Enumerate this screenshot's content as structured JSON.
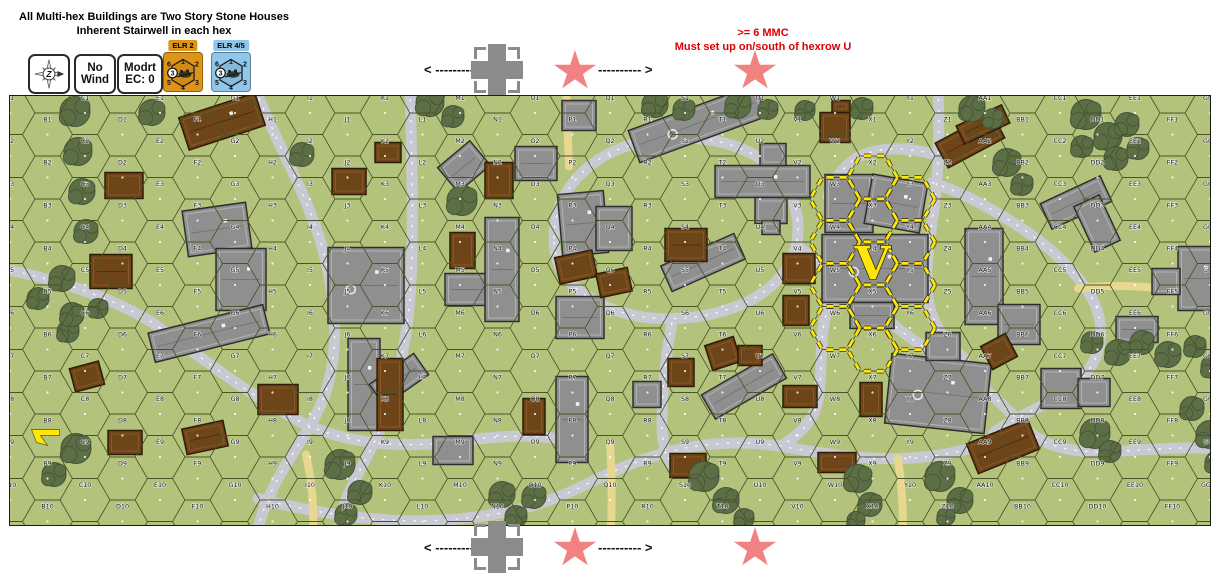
{
  "header": {
    "instructions_line1": "All Multi-hex Buildings are Two Story Stone Houses",
    "instructions_line2": "Inherent Stairwell in each hex",
    "counters": {
      "compass": {
        "letter": "Z"
      },
      "wind": {
        "line1": "No",
        "line2": "Wind"
      },
      "conditions": {
        "line1": "Modrt",
        "line2": "EC: 0"
      },
      "elr_axis": {
        "tab": "ELR 2",
        "color": "#dd9418",
        "edge_numbers": [
          "6",
          "1",
          "2",
          "5",
          "4",
          "3"
        ],
        "circled_value": "3"
      },
      "elr_allied": {
        "tab": "ELR 4/5",
        "color": "#8fc6e9",
        "edge_numbers": [
          "6",
          "1",
          "2",
          "5",
          "4",
          "3"
        ],
        "circled_value": "3"
      }
    },
    "setup_note": {
      "line1": ">= 6 MMC",
      "line2": "Must set up on/south of hexrow U",
      "color": "#dd0000"
    }
  },
  "strips": {
    "top": {
      "left": "< ----------",
      "right": "---------- >"
    },
    "bottom": {
      "left": "< ----------",
      "right": "---------- >"
    }
  },
  "map": {
    "columns": [
      "A",
      "B",
      "C",
      "D",
      "E",
      "F",
      "G",
      "H",
      "I",
      "J",
      "K",
      "L",
      "M",
      "N",
      "O",
      "P",
      "Q",
      "R",
      "S",
      "T",
      "U",
      "V",
      "W",
      "X",
      "Y",
      "Z",
      "AA",
      "BB",
      "CC",
      "DD",
      "EE",
      "FF",
      "GG"
    ],
    "rows": 10,
    "colors": {
      "grass": "#b3c37c",
      "hexline": "#4a5528",
      "road": "#c9c9d3",
      "road_center": "#ffffff",
      "dirt": "#e7d78f",
      "stone": "#8f8f8f",
      "stone_edge": "#2f2f2f",
      "stone_inner": "#c4c4c4",
      "wood": "#6e4419",
      "wood_edge": "#2e1c08",
      "wood_inner": "#96652f",
      "tree": "#5c6e44",
      "tree_edge": "#43523a",
      "setup_yellow": "#ffe60a",
      "setup_under": "#262615"
    },
    "v_marker": {
      "label": "V",
      "hex": "X4"
    },
    "setup_hexes": [
      "W3",
      "W4",
      "W5",
      "W6",
      "X2",
      "X3",
      "X4",
      "X5",
      "X6",
      "Y3",
      "Y4",
      "Y5",
      "Y6"
    ],
    "arrow_marker_hex": "B8",
    "roads": [
      "M 245,-8 C 268,50 298,100 312,150 C 326,200 330,250 316,295 C 300,342 262,375 248,432",
      "M 400,-8 C 402,70 404,140 400,200 C 396,258 380,318 356,362 C 338,396 330,415 330,432",
      "M -8,172 C 50,184 100,200 142,226 C 186,256 232,295 290,325 C 336,348 392,352 446,345 C 492,339 522,338 546,342",
      "M 248,402 C 310,418 380,428 442,423 C 502,418 540,406 576,388 C 612,370 642,358 678,351 C 712,345 742,345 772,350 C 830,360 860,363 892,362 C 928,361 958,354 984,344",
      "M 544,142 C 544,94 580,54 640,44 C 700,34 760,52 780,96 C 798,136 786,180 740,204 C 696,226 636,228 596,210 C 560,194 544,172 544,142 Z",
      "M 788,150 C 826,178 858,206 888,232 C 918,256 950,272 974,292 C 996,310 1008,324 1018,334 C 1034,350 1064,357 1102,355 C 1142,353 1176,350 1208,352",
      "M 928,-8 C 930,40 928,88 922,126 C 918,156 914,184 919,208 C 924,230 936,246 954,262",
      "M 922,86 C 952,96 982,112 1012,132 C 1042,152 1062,172 1076,192 C 1090,212 1094,232 1088,254 C 1082,278 1058,296 1030,310 C 1006,322 992,330 984,336",
      "M 662,226 C 656,258 652,292 652,326 C 652,346 656,358 662,368",
      "M 846,164 C 828,184 816,208 813,234 C 810,258 812,284 808,304 C 804,324 790,338 772,349",
      "M 924,58 C 896,50 866,50 846,62 C 831,72 822,86 818,100"
    ],
    "dirt_roads": [
      "M 556,-8 C 557,20 558,45 559,70",
      "M 600,348 C 602,375 602,404 601,432",
      "M 888,362 C 892,390 893,412 893,432",
      "M 1068,192 C 1110,186 1155,192 1208,198",
      "M 296,358 C 302,385 304,408 303,432"
    ],
    "buildings": [
      {
        "x": 175,
        "y": 110,
        "w": 64,
        "h": 46,
        "rot": -8,
        "type": "stone"
      },
      {
        "x": 206,
        "y": 152,
        "w": 50,
        "h": 62,
        "rot": 0,
        "type": "stone"
      },
      {
        "x": 318,
        "y": 151,
        "w": 76,
        "h": 76,
        "rot": 0,
        "type": "stone"
      },
      {
        "x": 140,
        "y": 222,
        "w": 118,
        "h": 30,
        "rot": -14,
        "type": "stone"
      },
      {
        "x": 505,
        "y": 50,
        "w": 42,
        "h": 34,
        "rot": 0,
        "type": "stone"
      },
      {
        "x": 433,
        "y": 54,
        "w": 42,
        "h": 32,
        "rot": -40,
        "type": "stone"
      },
      {
        "x": 552,
        "y": 4,
        "w": 34,
        "h": 30,
        "rot": 0,
        "type": "stone"
      },
      {
        "x": 620,
        "y": 10,
        "w": 135,
        "h": 34,
        "rot": -20,
        "type": "stone"
      },
      {
        "x": 550,
        "y": 96,
        "w": 46,
        "h": 62,
        "rot": -5,
        "type": "stone"
      },
      {
        "x": 586,
        "y": 110,
        "w": 36,
        "h": 44,
        "rot": 0,
        "type": "stone"
      },
      {
        "x": 705,
        "y": 69,
        "w": 95,
        "h": 32,
        "rot": 0,
        "type": "stone"
      },
      {
        "x": 750,
        "y": 47,
        "w": 26,
        "h": 22,
        "rot": 0,
        "type": "stone"
      },
      {
        "x": 745,
        "y": 101,
        "w": 32,
        "h": 26,
        "rot": 0,
        "type": "stone"
      },
      {
        "x": 752,
        "y": 124,
        "w": 18,
        "h": 14,
        "rot": 0,
        "type": "stone"
      },
      {
        "x": 653,
        "y": 152,
        "w": 80,
        "h": 28,
        "rot": -24,
        "type": "stone"
      },
      {
        "x": 546,
        "y": 200,
        "w": 48,
        "h": 42,
        "rot": 0,
        "type": "stone"
      },
      {
        "x": 435,
        "y": 177,
        "w": 52,
        "h": 32,
        "rot": 0,
        "type": "stone"
      },
      {
        "x": 475,
        "y": 121,
        "w": 34,
        "h": 104,
        "rot": 0,
        "type": "stone"
      },
      {
        "x": 338,
        "y": 242,
        "w": 32,
        "h": 92,
        "rot": 0,
        "type": "stone"
      },
      {
        "x": 362,
        "y": 270,
        "w": 54,
        "h": 26,
        "rot": -35,
        "type": "stone"
      },
      {
        "x": 546,
        "y": 280,
        "w": 32,
        "h": 86,
        "rot": 0,
        "type": "stone"
      },
      {
        "x": 623,
        "y": 285,
        "w": 28,
        "h": 26,
        "rot": 0,
        "type": "stone"
      },
      {
        "x": 693,
        "y": 276,
        "w": 82,
        "h": 28,
        "rot": -30,
        "type": "stone"
      },
      {
        "x": 423,
        "y": 340,
        "w": 40,
        "h": 28,
        "rot": 0,
        "type": "stone"
      },
      {
        "x": 815,
        "y": 78,
        "w": 48,
        "h": 58,
        "rot": 0,
        "type": "stone"
      },
      {
        "x": 858,
        "y": 82,
        "w": 56,
        "h": 50,
        "rot": 10,
        "type": "stone"
      },
      {
        "x": 812,
        "y": 138,
        "w": 106,
        "h": 68,
        "rot": 0,
        "type": "stone"
      },
      {
        "x": 840,
        "y": 206,
        "w": 44,
        "h": 26,
        "rot": 0,
        "type": "stone"
      },
      {
        "x": 955,
        "y": 132,
        "w": 38,
        "h": 96,
        "rot": 0,
        "type": "stone"
      },
      {
        "x": 988,
        "y": 208,
        "w": 42,
        "h": 40,
        "rot": 0,
        "type": "stone"
      },
      {
        "x": 878,
        "y": 262,
        "w": 100,
        "h": 70,
        "rot": 6,
        "type": "stone"
      },
      {
        "x": 916,
        "y": 236,
        "w": 34,
        "h": 28,
        "rot": 0,
        "type": "stone"
      },
      {
        "x": 1033,
        "y": 92,
        "w": 66,
        "h": 28,
        "rot": -25,
        "type": "stone"
      },
      {
        "x": 1073,
        "y": 102,
        "w": 28,
        "h": 50,
        "rot": -25,
        "type": "stone"
      },
      {
        "x": 1168,
        "y": 150,
        "w": 42,
        "h": 64,
        "rot": 0,
        "type": "stone"
      },
      {
        "x": 1142,
        "y": 172,
        "w": 28,
        "h": 26,
        "rot": 0,
        "type": "stone"
      },
      {
        "x": 1106,
        "y": 220,
        "w": 42,
        "h": 26,
        "rot": 0,
        "type": "stone"
      },
      {
        "x": 1031,
        "y": 272,
        "w": 40,
        "h": 40,
        "rot": 0,
        "type": "stone"
      },
      {
        "x": 1068,
        "y": 282,
        "w": 32,
        "h": 28,
        "rot": 0,
        "type": "stone"
      },
      {
        "x": 172,
        "y": 8,
        "w": 80,
        "h": 34,
        "rot": -18,
        "type": "wood"
      },
      {
        "x": 95,
        "y": 76,
        "w": 38,
        "h": 26,
        "rot": 0,
        "type": "wood"
      },
      {
        "x": 80,
        "y": 158,
        "w": 42,
        "h": 34,
        "rot": 0,
        "type": "wood"
      },
      {
        "x": 62,
        "y": 268,
        "w": 30,
        "h": 24,
        "rot": -15,
        "type": "wood"
      },
      {
        "x": 98,
        "y": 334,
        "w": 34,
        "h": 24,
        "rot": 0,
        "type": "wood"
      },
      {
        "x": 174,
        "y": 328,
        "w": 42,
        "h": 26,
        "rot": -12,
        "type": "wood"
      },
      {
        "x": 248,
        "y": 288,
        "w": 40,
        "h": 30,
        "rot": 0,
        "type": "wood"
      },
      {
        "x": 322,
        "y": 72,
        "w": 34,
        "h": 26,
        "rot": 0,
        "type": "wood"
      },
      {
        "x": 365,
        "y": 46,
        "w": 26,
        "h": 20,
        "rot": 0,
        "type": "wood"
      },
      {
        "x": 475,
        "y": 66,
        "w": 28,
        "h": 36,
        "rot": 0,
        "type": "wood"
      },
      {
        "x": 440,
        "y": 136,
        "w": 25,
        "h": 36,
        "rot": 0,
        "type": "wood"
      },
      {
        "x": 367,
        "y": 262,
        "w": 26,
        "h": 72,
        "rot": 0,
        "type": "wood"
      },
      {
        "x": 547,
        "y": 157,
        "w": 38,
        "h": 27,
        "rot": -12,
        "type": "wood"
      },
      {
        "x": 588,
        "y": 174,
        "w": 32,
        "h": 24,
        "rot": -12,
        "type": "wood"
      },
      {
        "x": 655,
        "y": 132,
        "w": 42,
        "h": 33,
        "rot": 0,
        "type": "wood"
      },
      {
        "x": 698,
        "y": 244,
        "w": 30,
        "h": 26,
        "rot": -18,
        "type": "wood"
      },
      {
        "x": 773,
        "y": 157,
        "w": 32,
        "h": 30,
        "rot": 0,
        "type": "wood"
      },
      {
        "x": 773,
        "y": 199,
        "w": 26,
        "h": 30,
        "rot": 0,
        "type": "wood"
      },
      {
        "x": 810,
        "y": 16,
        "w": 30,
        "h": 30,
        "rot": 0,
        "type": "wood"
      },
      {
        "x": 822,
        "y": 4,
        "w": 18,
        "h": 12,
        "rot": 0,
        "type": "wood"
      },
      {
        "x": 928,
        "y": 30,
        "w": 64,
        "h": 28,
        "rot": -28,
        "type": "wood"
      },
      {
        "x": 948,
        "y": 18,
        "w": 50,
        "h": 20,
        "rot": -25,
        "type": "wood"
      },
      {
        "x": 513,
        "y": 302,
        "w": 22,
        "h": 36,
        "rot": 0,
        "type": "wood"
      },
      {
        "x": 658,
        "y": 262,
        "w": 26,
        "h": 28,
        "rot": 0,
        "type": "wood"
      },
      {
        "x": 660,
        "y": 357,
        "w": 36,
        "h": 24,
        "rot": 0,
        "type": "wood"
      },
      {
        "x": 773,
        "y": 289,
        "w": 34,
        "h": 22,
        "rot": 0,
        "type": "wood"
      },
      {
        "x": 808,
        "y": 356,
        "w": 38,
        "h": 20,
        "rot": 0,
        "type": "wood"
      },
      {
        "x": 850,
        "y": 286,
        "w": 22,
        "h": 34,
        "rot": 0,
        "type": "wood"
      },
      {
        "x": 960,
        "y": 334,
        "w": 66,
        "h": 32,
        "rot": -22,
        "type": "wood"
      },
      {
        "x": 975,
        "y": 242,
        "w": 28,
        "h": 26,
        "rot": -28,
        "type": "wood"
      },
      {
        "x": 728,
        "y": 249,
        "w": 24,
        "h": 20,
        "rot": 0,
        "type": "wood"
      }
    ],
    "trees": [
      [
        65,
        15,
        15
      ],
      [
        68,
        55,
        14
      ],
      [
        72,
        95,
        13
      ],
      [
        76,
        135,
        12
      ],
      [
        52,
        182,
        13
      ],
      [
        28,
        202,
        11
      ],
      [
        88,
        212,
        10
      ],
      [
        58,
        235,
        11
      ],
      [
        142,
        16,
        13
      ],
      [
        62,
        218,
        12
      ],
      [
        66,
        352,
        15
      ],
      [
        44,
        378,
        12
      ],
      [
        292,
        58,
        12
      ],
      [
        420,
        6,
        14
      ],
      [
        443,
        20,
        11
      ],
      [
        452,
        104,
        15
      ],
      [
        645,
        8,
        13
      ],
      [
        674,
        13,
        11
      ],
      [
        728,
        9,
        13
      ],
      [
        758,
        13,
        10
      ],
      [
        795,
        14,
        10
      ],
      [
        852,
        12,
        11
      ],
      [
        962,
        12,
        13
      ],
      [
        983,
        22,
        10
      ],
      [
        997,
        66,
        14
      ],
      [
        1012,
        88,
        11
      ],
      [
        1076,
        18,
        15
      ],
      [
        1098,
        40,
        14
      ],
      [
        1117,
        28,
        12
      ],
      [
        1072,
        50,
        11
      ],
      [
        1106,
        62,
        12
      ],
      [
        1128,
        52,
        11
      ],
      [
        1082,
        246,
        11
      ],
      [
        1108,
        256,
        13
      ],
      [
        1132,
        246,
        12
      ],
      [
        1158,
        258,
        13
      ],
      [
        1185,
        250,
        11
      ],
      [
        1203,
        270,
        12
      ],
      [
        1085,
        337,
        15
      ],
      [
        1100,
        355,
        11
      ],
      [
        1182,
        312,
        12
      ],
      [
        1200,
        338,
        14
      ],
      [
        1206,
        366,
        11
      ],
      [
        330,
        368,
        15
      ],
      [
        350,
        396,
        12
      ],
      [
        336,
        418,
        11
      ],
      [
        492,
        398,
        13
      ],
      [
        506,
        420,
        11
      ],
      [
        524,
        400,
        12
      ],
      [
        694,
        380,
        15
      ],
      [
        716,
        404,
        13
      ],
      [
        734,
        422,
        10
      ],
      [
        848,
        382,
        14
      ],
      [
        860,
        408,
        12
      ],
      [
        846,
        424,
        9
      ],
      [
        930,
        380,
        15
      ],
      [
        950,
        404,
        13
      ],
      [
        936,
        420,
        9
      ]
    ]
  }
}
